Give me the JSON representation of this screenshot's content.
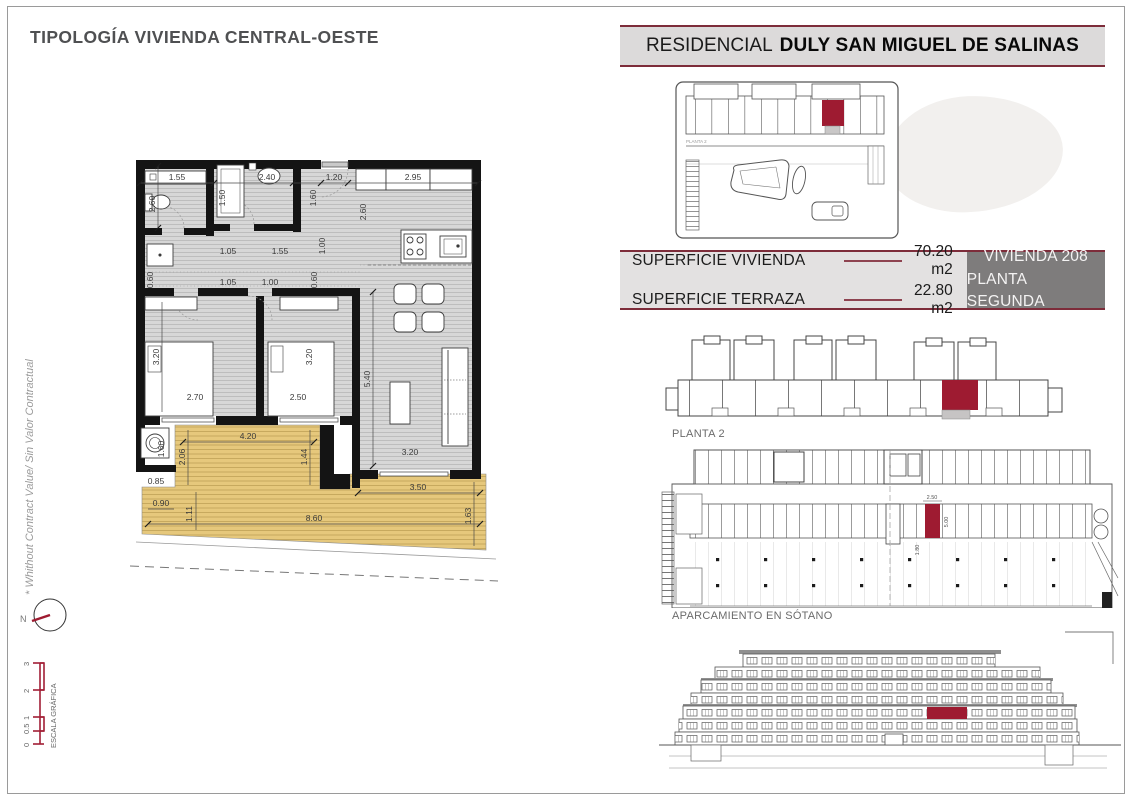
{
  "page": {
    "title": "TIPOLOGÍA VIVIENDA CENTRAL-OESTE",
    "side_note": "* Whithout Contract Value/ Sin Valor Contractual",
    "compass_n": "N"
  },
  "scale_bar": {
    "label": "ESCALA GRÁFICA",
    "ticks": [
      "0",
      "0.5",
      "1",
      "2",
      "3"
    ]
  },
  "header": {
    "prefix": "RESIDENCIAL",
    "name": "DULY SAN MIGUEL DE SALINAS"
  },
  "site_plan": {
    "tiny_label": "PLANTA 2"
  },
  "summary": {
    "rows": [
      {
        "label": "SUPERFICIE VIVIENDA",
        "value": "70.20 m2"
      },
      {
        "label": "SUPERFICIE TERRAZA",
        "value": "22.80 m2"
      }
    ],
    "unit_line1": "VIVIENDA 208",
    "unit_line2": "PLANTA SEGUNDA"
  },
  "planta2": {
    "label": "PLANTA 2"
  },
  "parking": {
    "label": "APARCAMIENTO EN SÓTANO",
    "stall_width": "2.50",
    "stall_depth": "5.00",
    "stall_offset": "1.80"
  },
  "floorplan": {
    "dims": {
      "t1": "1.55",
      "t2": "2.40",
      "t3": "1.20",
      "t4": "2.95",
      "v_left": "2.60",
      "bath2_w": "1.50",
      "entry_h": "1.60",
      "kitchen_h": "2.60",
      "hall_a": "1.05",
      "hall_b": "1.55",
      "hall_c": "1.00",
      "ledge_l": "0.60",
      "hall_d": "1.05",
      "hall_e": "1.00",
      "ledge_r": "0.60",
      "bed1_d": "3.20",
      "bed1_w": "2.70",
      "bed2_d": "3.20",
      "bed2_w": "2.50",
      "living_d": "5.40",
      "living_w": "3.20",
      "terr_a": "4.20",
      "terr_b": "1.44",
      "terr_c": "2.06",
      "wash_a": "1.60",
      "wash_b": "0.85",
      "terr_d": "0.90",
      "terr_e": "1.11",
      "terr_f": "8.60",
      "terr_g": "3.50",
      "terr_h": "1.63"
    }
  },
  "colors": {
    "accent_red": "#9e1b31",
    "rule_red": "#7d2c3a",
    "dash_red": "#8e4350",
    "floor_gray": "#d7d7d7",
    "terrace_tan": "#e6c87c",
    "panel_gray": "#e3e1e1",
    "box_gray": "#7e7c7c",
    "wall_black": "#141414"
  }
}
